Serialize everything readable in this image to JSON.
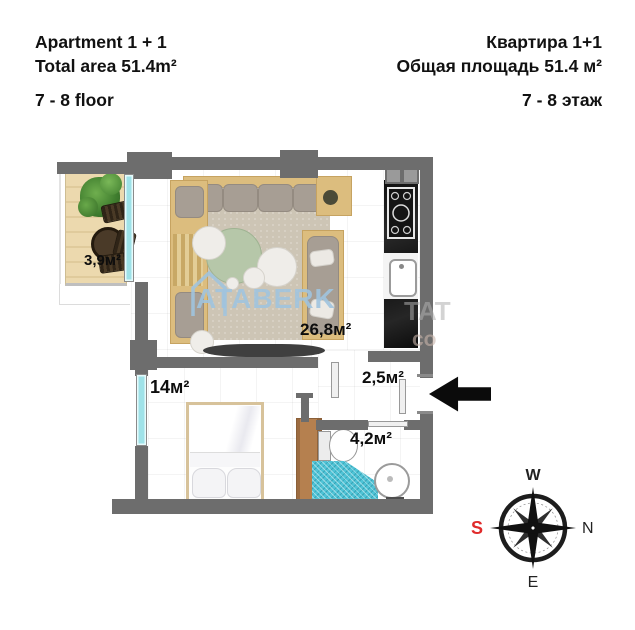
{
  "header": {
    "en": {
      "title": "Apartment 1 + 1",
      "area": "Total area 51.4m²",
      "floor": "7 - 8 floor"
    },
    "ru": {
      "title": "Квартира 1+1",
      "area": "Общая площадь 51.4 м²",
      "floor": "7 - 8 этаж"
    }
  },
  "plan": {
    "labels": {
      "balcony": "3,9м²",
      "living_room": "26,8м²",
      "bedroom": "14м²",
      "hallway": "2,5м²",
      "bathroom": "4,2м²"
    },
    "watermark": "ATABERK",
    "watermark_fragment_right": "TAT",
    "watermark_fragment_bottom": "co"
  },
  "compass": {
    "west": "W",
    "north": "N",
    "east": "E",
    "south": "S"
  },
  "colors": {
    "wall": "#6d6d6d",
    "window": "#9fe2e8",
    "balcony_wood": "#ecd9ae",
    "rug": "#cdc5b5",
    "sofa_wood": "#dcbd7e",
    "sofa_cushion": "#a79e94",
    "coffee_table": "#b6c7a9",
    "shower_tile": "#4fc3d6",
    "wardrobe": "#ad7a4e",
    "watermark_blue": "#a9c7df",
    "south_red": "#e02b2b",
    "arrow_black": "#0d0d0d"
  }
}
